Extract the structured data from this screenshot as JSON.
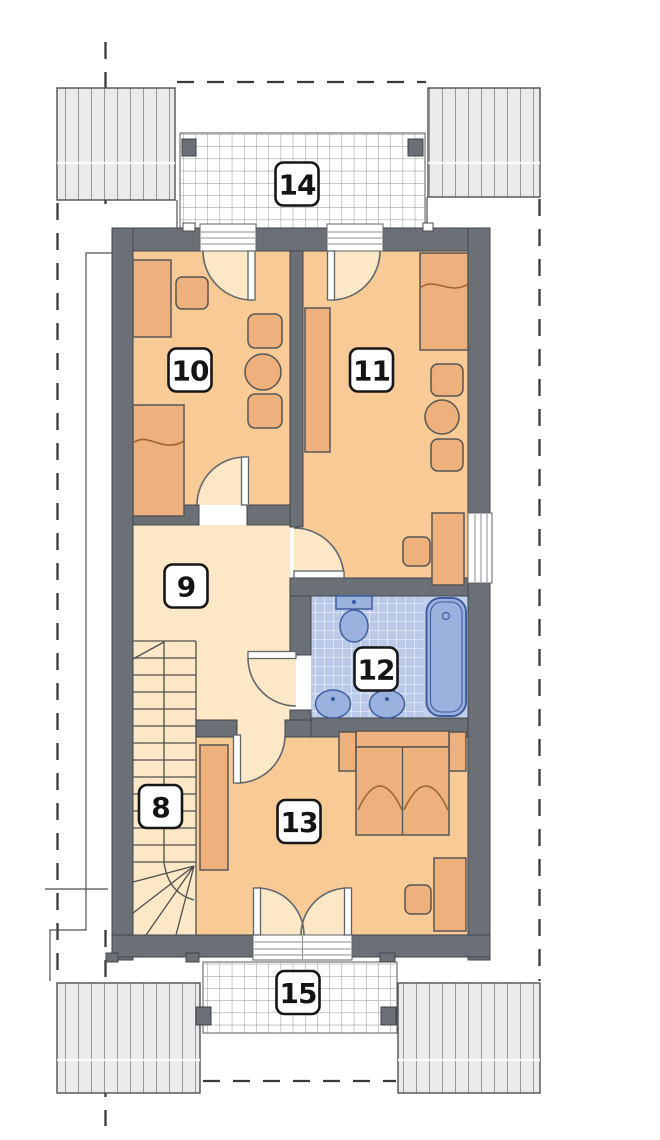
{
  "plan": {
    "room_labels": {
      "stairs": "8",
      "hallway": "9",
      "bedroom_top_left": "10",
      "bedroom_top_right": "11",
      "bathroom": "12",
      "bedroom_bottom": "13",
      "terrace_top": "14",
      "terrace_bottom": "15"
    },
    "colors": {
      "wall": "#6b7077",
      "bedroom_floor": "#f8ca96",
      "hallway_floor": "#fce8c6",
      "bathroom_tile": "#b9c9e7",
      "bathroom_fixture": "#9cb2de",
      "furniture": "#eeb17d",
      "roof_fill": "#ebebee"
    }
  }
}
